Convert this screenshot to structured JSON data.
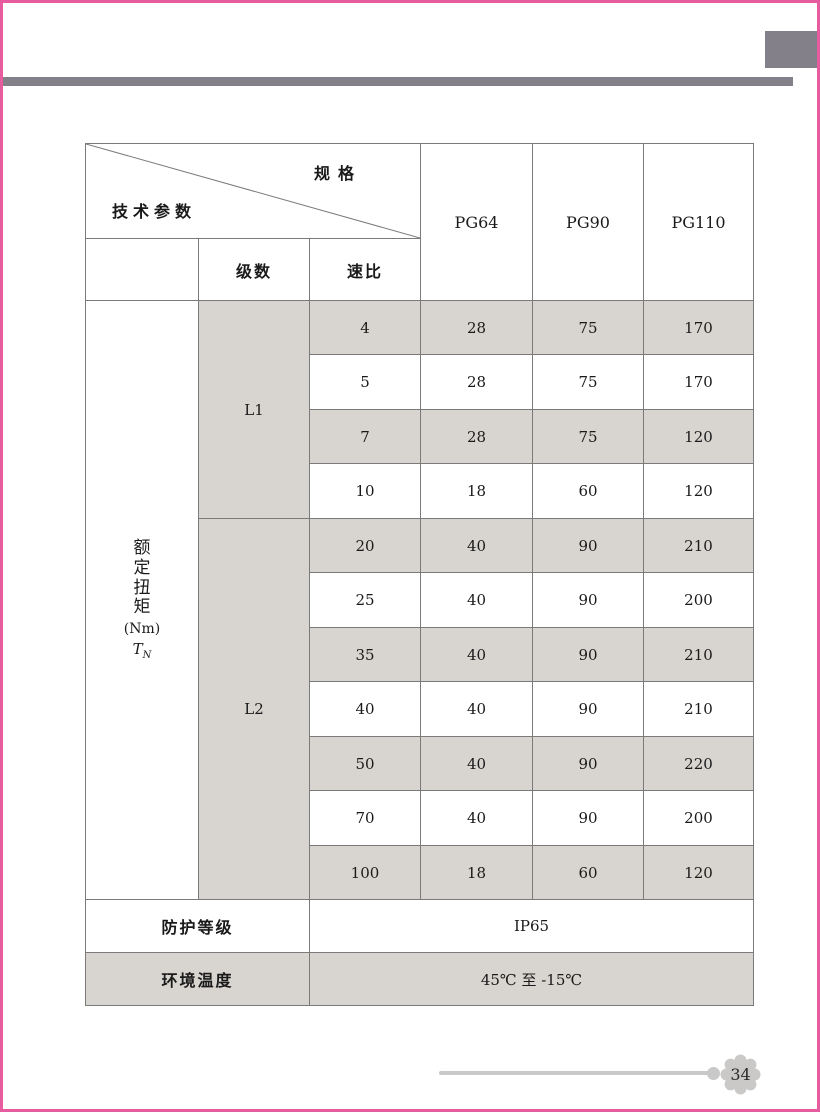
{
  "colors": {
    "accent_pink": "#e65c9f",
    "decor_gray": "#848089",
    "cell_gray": "#d8d5d0",
    "table_line": "#7a7a7a",
    "footer_gray": "#c9c9c9"
  },
  "table": {
    "corner": {
      "top_label": "规格",
      "bottom_label": "技术参数"
    },
    "columns": [
      "PG64",
      "PG90",
      "PG110"
    ],
    "subheaders": {
      "stages": "级数",
      "ratio": "速比"
    },
    "torque_label": {
      "vertical": "额定扭矩",
      "unit": "(Nm)",
      "symbol": "T",
      "symbol_sub": "N"
    },
    "groups": [
      {
        "label": "L1"
      },
      {
        "label": "L2"
      }
    ],
    "rows": [
      {
        "ratio": "4",
        "pg64": "28",
        "pg90": "75",
        "pg110": "170"
      },
      {
        "ratio": "5",
        "pg64": "28",
        "pg90": "75",
        "pg110": "170"
      },
      {
        "ratio": "7",
        "pg64": "28",
        "pg90": "75",
        "pg110": "120"
      },
      {
        "ratio": "10",
        "pg64": "18",
        "pg90": "60",
        "pg110": "120"
      },
      {
        "ratio": "20",
        "pg64": "40",
        "pg90": "90",
        "pg110": "210"
      },
      {
        "ratio": "25",
        "pg64": "40",
        "pg90": "90",
        "pg110": "200"
      },
      {
        "ratio": "35",
        "pg64": "40",
        "pg90": "90",
        "pg110": "210"
      },
      {
        "ratio": "40",
        "pg64": "40",
        "pg90": "90",
        "pg110": "210"
      },
      {
        "ratio": "50",
        "pg64": "40",
        "pg90": "90",
        "pg110": "220"
      },
      {
        "ratio": "70",
        "pg64": "40",
        "pg90": "90",
        "pg110": "200"
      },
      {
        "ratio": "100",
        "pg64": "18",
        "pg90": "60",
        "pg110": "120"
      }
    ],
    "protection": {
      "label": "防护等级",
      "value": "IP65"
    },
    "temperature": {
      "label": "环境温度",
      "value": "45℃ 至 -15℃"
    }
  },
  "footer": {
    "page_number": "34"
  }
}
